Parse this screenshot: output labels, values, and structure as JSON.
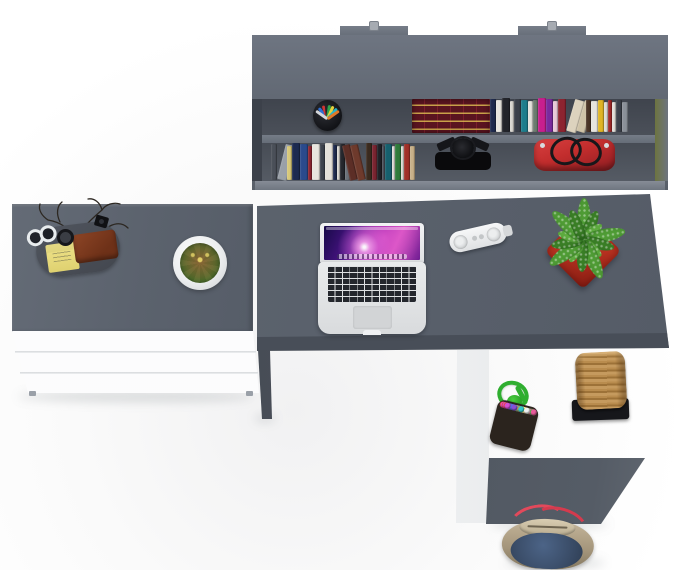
{
  "scene": {
    "label": "Top view 3D render of a home-office furniture set: wall shelf with books, white chest of drawers and grey L-shaped desk with accessories on a white floor",
    "palette": {
      "furniture_gray": "#5b626d",
      "recess_gray": "#474c55",
      "edge_light_gray": "#7e8590",
      "front_dark_gray": "#4a505a",
      "panel_white": "#f5f6f7",
      "pot_red": "#bc3322",
      "leaf_green": "#4f9c35",
      "rope_green": "#2fae2f",
      "bag_red": "#c22d2d",
      "basket_tan": "#b3874d",
      "denim_blue": "#3c4f6b",
      "strap_red": "#e2495b",
      "wallet_brown": "#7b3a22",
      "notepad_yellow": "#e9dd82"
    },
    "objects": {
      "wall_shelf": {
        "label": "Wall-mounted shelf with two book rows"
      },
      "pen_cup": {
        "label": "Black cup with colored pens"
      },
      "antique_books": {
        "label": "Dark red antique book set with gold spines"
      },
      "top_book_row": {
        "label": "Row of books on upper shelf"
      },
      "bottom_book_row": {
        "label": "Row of books on lower shelf"
      },
      "black_lamp": {
        "label": "Black folded desk lamp"
      },
      "red_bag": {
        "label": "Red handbag with black handles"
      },
      "dresser": {
        "label": "White chest of drawers with grey top"
      },
      "tray": {
        "label": "Grey accessory tray"
      },
      "notepad": {
        "label": "Yellow sticky notepad"
      },
      "wallet": {
        "label": "Brown leather wallet"
      },
      "glasses": {
        "label": "White eyeglasses"
      },
      "watch": {
        "label": "Black wristwatch"
      },
      "branches": {
        "label": "Decorative dry branches"
      },
      "clip_cam": {
        "label": "Small black clip"
      },
      "cactus": {
        "label": "Cactus in round white pot"
      },
      "desk": {
        "label": "Grey L-shaped desk"
      },
      "laptop": {
        "label": "Open laptop with purple nebula wallpaper"
      },
      "speaker": {
        "label": "White pill-shaped portable speaker"
      },
      "plant": {
        "label": "Green succulent in red square planter"
      },
      "beaded_bag": {
        "label": "Multicolor beaded pouch with green cord"
      },
      "basket": {
        "label": "Wicker basket on black stand"
      },
      "duffel": {
        "label": "Canvas tote bag with red straps"
      }
    },
    "shelf": {
      "books_top": [
        {
          "x": 490,
          "w": 6,
          "h": 33,
          "c": "#1e2a4e"
        },
        {
          "x": 496,
          "w": 6,
          "h": 32,
          "c": "#e8e6e0"
        },
        {
          "x": 502,
          "w": 8,
          "h": 34,
          "c": "#22242a"
        },
        {
          "x": 510,
          "w": 4,
          "h": 31,
          "c": "#d8d6d0"
        },
        {
          "x": 514,
          "w": 7,
          "h": 33,
          "c": "#3a3f49"
        },
        {
          "x": 521,
          "w": 7,
          "h": 32,
          "c": "#1e7d8c"
        },
        {
          "x": 528,
          "w": 5,
          "h": 31,
          "c": "#e4e2dc"
        },
        {
          "x": 533,
          "w": 5,
          "h": 32,
          "c": "#6b7a6e"
        },
        {
          "x": 538,
          "w": 8,
          "h": 34,
          "c": "#c81f8e"
        },
        {
          "x": 546,
          "w": 7,
          "h": 33,
          "c": "#7a2a9e"
        },
        {
          "x": 553,
          "w": 5,
          "h": 31,
          "c": "#e8c9d8"
        },
        {
          "x": 558,
          "w": 8,
          "h": 33,
          "c": "#8c2430"
        },
        {
          "x": 566,
          "w": 10,
          "h": 33,
          "c": "#ddd3be",
          "lean": 16
        },
        {
          "x": 576,
          "w": 9,
          "h": 32,
          "c": "#cfc3a8",
          "lean": 16
        },
        {
          "x": 586,
          "w": 5,
          "h": 32,
          "c": "#4a3426"
        },
        {
          "x": 591,
          "w": 7,
          "h": 31,
          "c": "#e6e4de"
        },
        {
          "x": 598,
          "w": 6,
          "h": 32,
          "c": "#e0b424"
        },
        {
          "x": 604,
          "w": 4,
          "h": 30,
          "c": "#dedcd6"
        },
        {
          "x": 608,
          "w": 4,
          "h": 32,
          "c": "#a02828"
        },
        {
          "x": 612,
          "w": 4,
          "h": 30,
          "c": "#e2e0da"
        },
        {
          "x": 616,
          "w": 6,
          "h": 32,
          "c": "#3c414b"
        },
        {
          "x": 622,
          "w": 6,
          "h": 30,
          "c": "#8a9098"
        }
      ],
      "books_bottom": [
        {
          "x": 271,
          "w": 6,
          "h": 36,
          "c": "#4a4f58"
        },
        {
          "x": 277,
          "w": 10,
          "h": 36,
          "c": "#9aa0a8",
          "lean": 14
        },
        {
          "x": 287,
          "w": 5,
          "h": 34,
          "c": "#d8c878"
        },
        {
          "x": 292,
          "w": 8,
          "h": 37,
          "c": "#1c2a50"
        },
        {
          "x": 300,
          "w": 8,
          "h": 36,
          "c": "#2a4a8c"
        },
        {
          "x": 308,
          "w": 4,
          "h": 34,
          "c": "#8c2430"
        },
        {
          "x": 312,
          "w": 8,
          "h": 36,
          "c": "#e8e5de"
        },
        {
          "x": 320,
          "w": 5,
          "h": 35,
          "c": "#3c424c"
        },
        {
          "x": 325,
          "w": 8,
          "h": 37,
          "c": "#e4e1da"
        },
        {
          "x": 333,
          "w": 4,
          "h": 35,
          "c": "#1e2a4e"
        },
        {
          "x": 337,
          "w": 3,
          "h": 34,
          "c": "#dcdad4"
        },
        {
          "x": 340,
          "w": 5,
          "h": 36,
          "c": "#24262c"
        },
        {
          "x": 345,
          "w": 5,
          "h": 34,
          "c": "#6a7078"
        },
        {
          "x": 350,
          "w": 8,
          "h": 36,
          "c": "#5c2e26",
          "lean": -13
        },
        {
          "x": 358,
          "w": 8,
          "h": 36,
          "c": "#6e3a2c",
          "lean": -13
        },
        {
          "x": 366,
          "w": 6,
          "h": 37,
          "c": "#3a2a1e"
        },
        {
          "x": 372,
          "w": 5,
          "h": 35,
          "c": "#7a2430"
        },
        {
          "x": 377,
          "w": 5,
          "h": 36,
          "c": "#1e2026"
        },
        {
          "x": 382,
          "w": 3,
          "h": 34,
          "c": "#4a505a"
        },
        {
          "x": 385,
          "w": 7,
          "h": 36,
          "c": "#16606e"
        },
        {
          "x": 392,
          "w": 3,
          "h": 34,
          "c": "#e0ded8"
        },
        {
          "x": 395,
          "w": 6,
          "h": 36,
          "c": "#2e7a3a"
        },
        {
          "x": 401,
          "w": 3,
          "h": 34,
          "c": "#dedcd6"
        },
        {
          "x": 404,
          "w": 6,
          "h": 36,
          "c": "#a03028"
        },
        {
          "x": 410,
          "w": 5,
          "h": 34,
          "c": "#c8b088"
        }
      ]
    },
    "pen_cup": {
      "pens": [
        {
          "color": "#2f6fd4",
          "angle": -38
        },
        {
          "color": "#d23434",
          "angle": -18
        },
        {
          "color": "#222428",
          "angle": -5
        },
        {
          "color": "#2fa24a",
          "angle": 8
        },
        {
          "color": "#e6d23c",
          "angle": 24
        },
        {
          "color": "#28b6c8",
          "angle": 42
        },
        {
          "color": "#d4d6da",
          "angle": -55
        },
        {
          "color": "#e07828",
          "angle": 55
        }
      ]
    },
    "plant": {
      "leaf_angles": [
        0,
        26,
        52,
        78,
        104,
        130,
        156,
        182,
        208,
        234,
        260,
        286,
        312,
        338
      ],
      "leaf_colors": [
        "#4f9c35",
        "#3a7f26",
        "#5fae3f"
      ]
    },
    "beads": {
      "colors": [
        "#e84343",
        "#f2d23c",
        "#3c7de8",
        "#46b14a",
        "#e8832e",
        "#d44fd4",
        "#f2f2f2",
        "#8a4fd4",
        "#e85a9a",
        "#35c8c8"
      ]
    }
  }
}
